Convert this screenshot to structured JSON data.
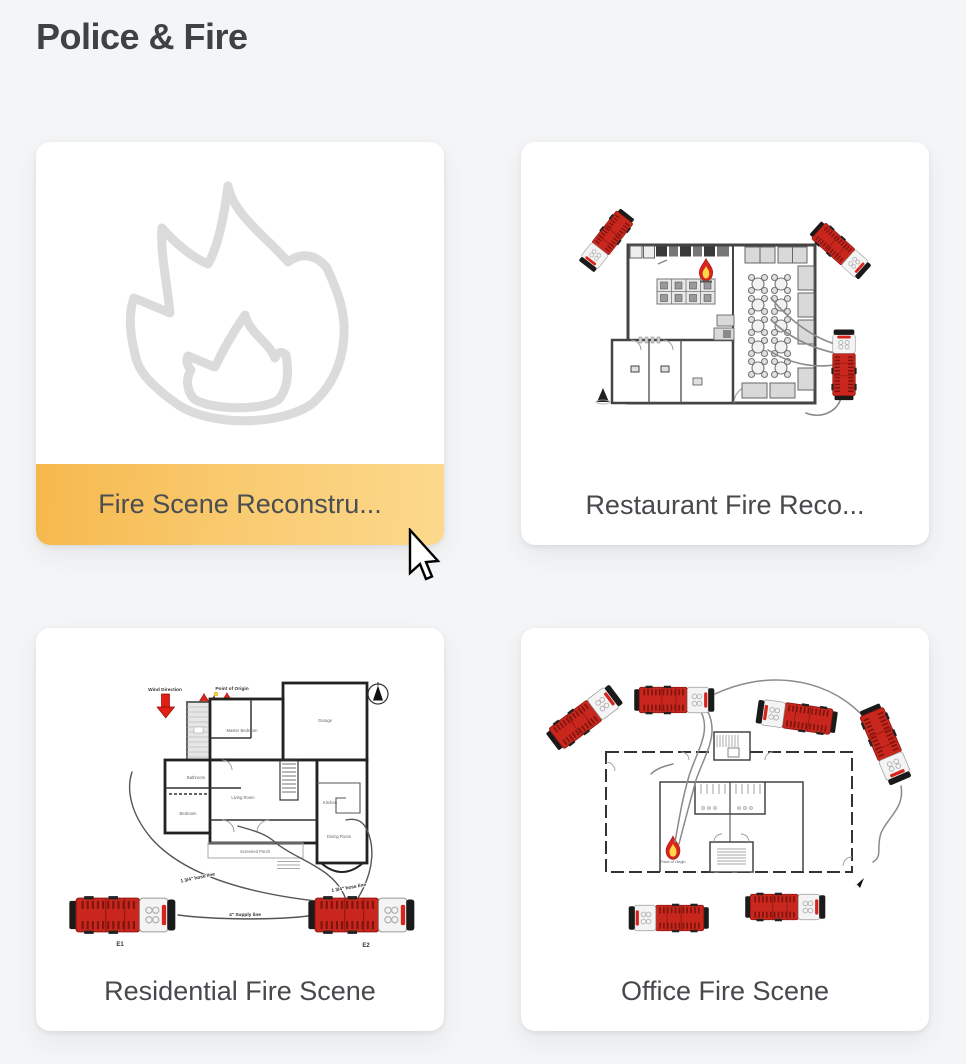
{
  "page": {
    "title": "Police & Fire"
  },
  "theme": {
    "background": "#F4F5F6",
    "card_background": "#FFFFFF",
    "label_color": "#47494D",
    "highlight_gradient_start": "#F6B84C",
    "highlight_gradient_end": "#FCD98D",
    "flame_outline_color": "#DBDBDB",
    "fire_truck_red": "#C9271E",
    "fire_icon_red": "#D6261E",
    "fire_icon_yellow": "#FFD54A",
    "wind_arrow_red": "#E21D12"
  },
  "cards": [
    {
      "label": "Fire Scene Reconstru...",
      "highlighted": true
    },
    {
      "label": "Restaurant Fire Reco...",
      "highlighted": false
    },
    {
      "label": "Residential Fire Scene",
      "highlighted": false
    },
    {
      "label": "Office Fire Scene",
      "highlighted": false
    }
  ],
  "residential": {
    "wind_direction_label": "Wind Direction",
    "point_of_origin_label": "Point of Origin",
    "hose_line_label_left": "1 3/4\" hose line",
    "hose_line_label_right": "1 3/4\" hose line",
    "supply_line_label": "4\" Supply line",
    "engine1_label": "E1",
    "engine2_label": "E2",
    "rooms": {
      "master_bedroom": "Master Bedroom",
      "bathroom": "Bathroom",
      "bedroom": "Bedroom",
      "living_room": "Living Room",
      "garage": "Garage",
      "kitchen": "Kitchen",
      "dining_room": "Dining Room",
      "screened_porch": "Screened Porch"
    }
  },
  "office": {
    "point_of_origin_label": "Point of Origin"
  }
}
